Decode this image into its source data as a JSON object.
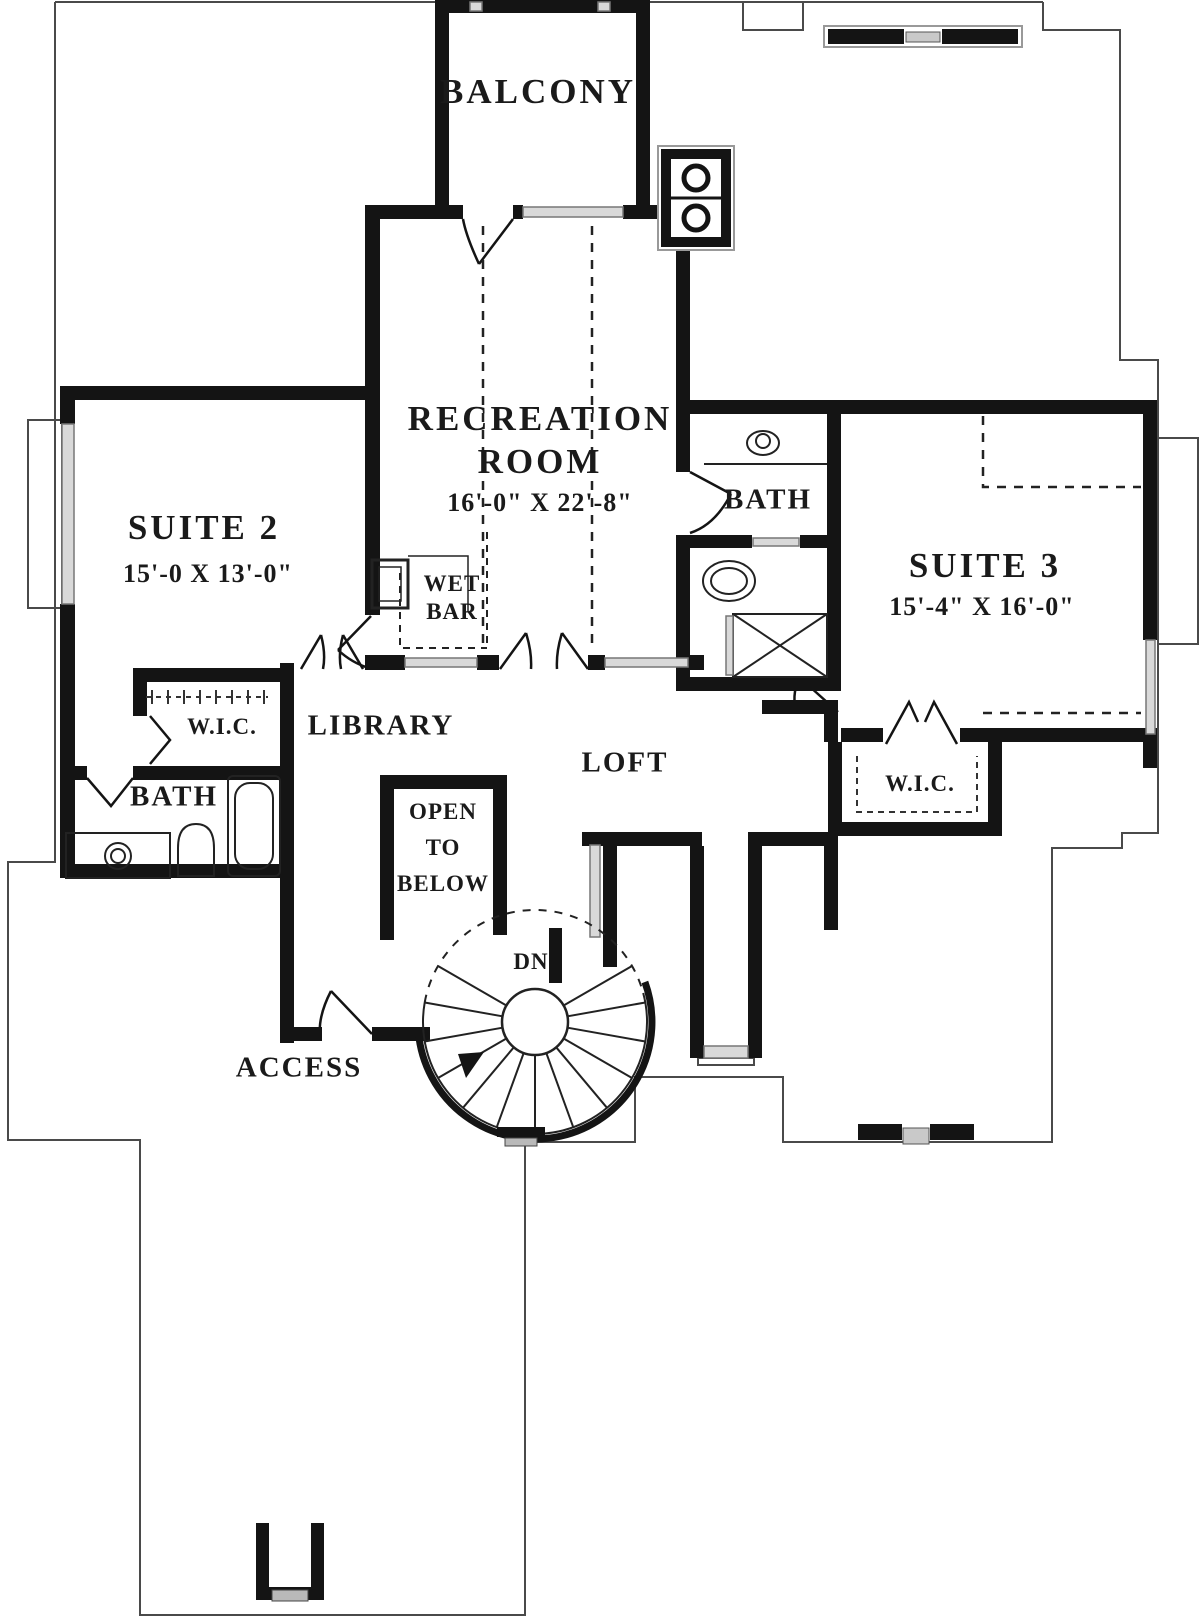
{
  "labels": {
    "balcony": "BALCONY",
    "recreation1": "RECREATION",
    "recreation2": "ROOM",
    "recreation_dims": "16'-0\" X 22'-8\"",
    "suite2": "SUITE 2",
    "suite2_dims": "15'-0 X 13'-0\"",
    "suite3": "SUITE 3",
    "suite3_dims": "15'-4\" X 16'-0\"",
    "bath_right": "BATH",
    "bath_left": "BATH",
    "wet1": "WET",
    "wet2": "BAR",
    "wic_left": "W.I.C.",
    "wic_right": "W.I.C.",
    "library": "LIBRARY",
    "loft": "LOFT",
    "open1": "OPEN",
    "open2": "TO",
    "open3": "BELOW",
    "dn": "DN",
    "access": "ACCESS"
  },
  "colors": {
    "wall": "#141414",
    "roofline": "#4a4a4a",
    "glass": "#d9d9d9",
    "text": "#1a1a1a",
    "background": "#ffffff"
  }
}
